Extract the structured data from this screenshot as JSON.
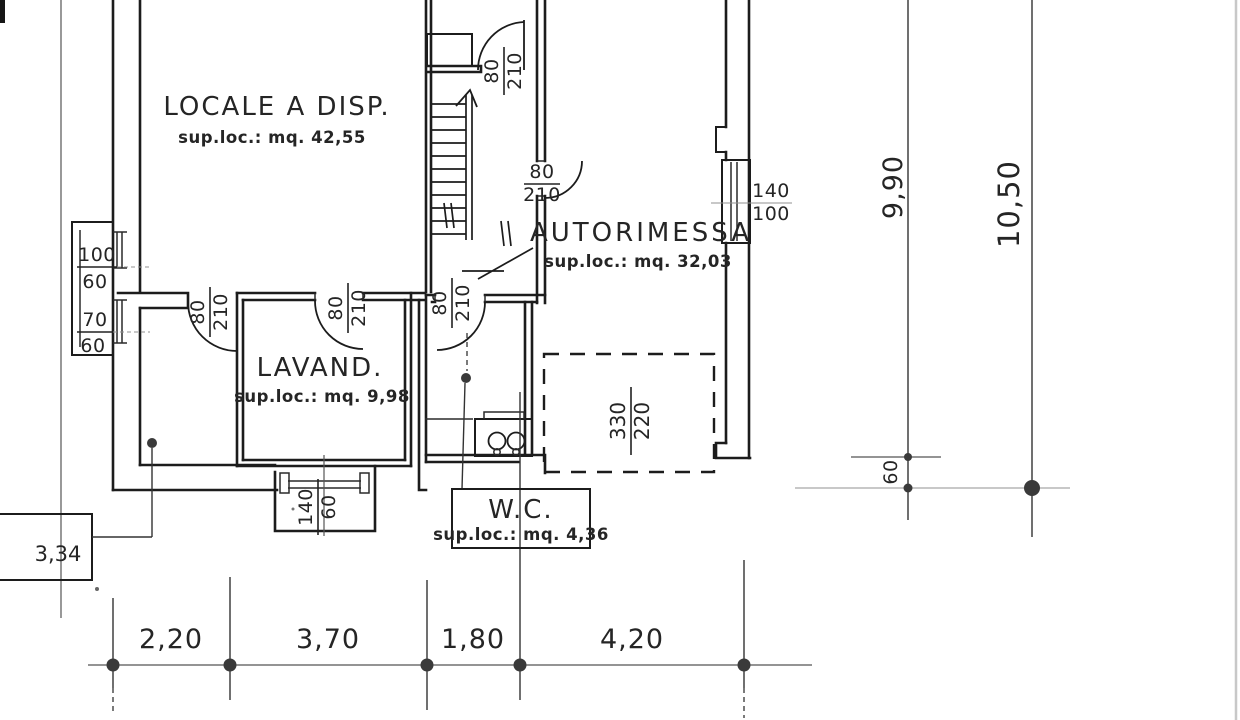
{
  "rooms": {
    "locale": {
      "name": "LOCALE A DISP.",
      "area": "sup.loc.: mq. 42,55"
    },
    "autorimessa": {
      "name": "AUTORIMESSA",
      "area": "sup.loc.: mq. 32,03"
    },
    "lavanderia": {
      "name": "LAVAND.",
      "area": "sup.loc.: mq. 9,98"
    },
    "wc": {
      "name": "W.C.",
      "area": "sup.loc.: mq. 4,36"
    }
  },
  "doors": {
    "w": "80",
    "h": "210"
  },
  "windows": {
    "left_upper": {
      "w": "100",
      "h": "60"
    },
    "left_lower": {
      "w": "70",
      "h": "60"
    },
    "bay": {
      "w": "140",
      "h": "60"
    },
    "garage": {
      "w": "140",
      "h": "100"
    }
  },
  "garage_opening": {
    "w": "330",
    "h": "220"
  },
  "dims": {
    "bottom": [
      "2,20",
      "3,70",
      "1,80",
      "4,20"
    ],
    "right_inner": "9,90",
    "right_outer": "10,50",
    "right_offset": "60",
    "leader_left": "3,34"
  }
}
